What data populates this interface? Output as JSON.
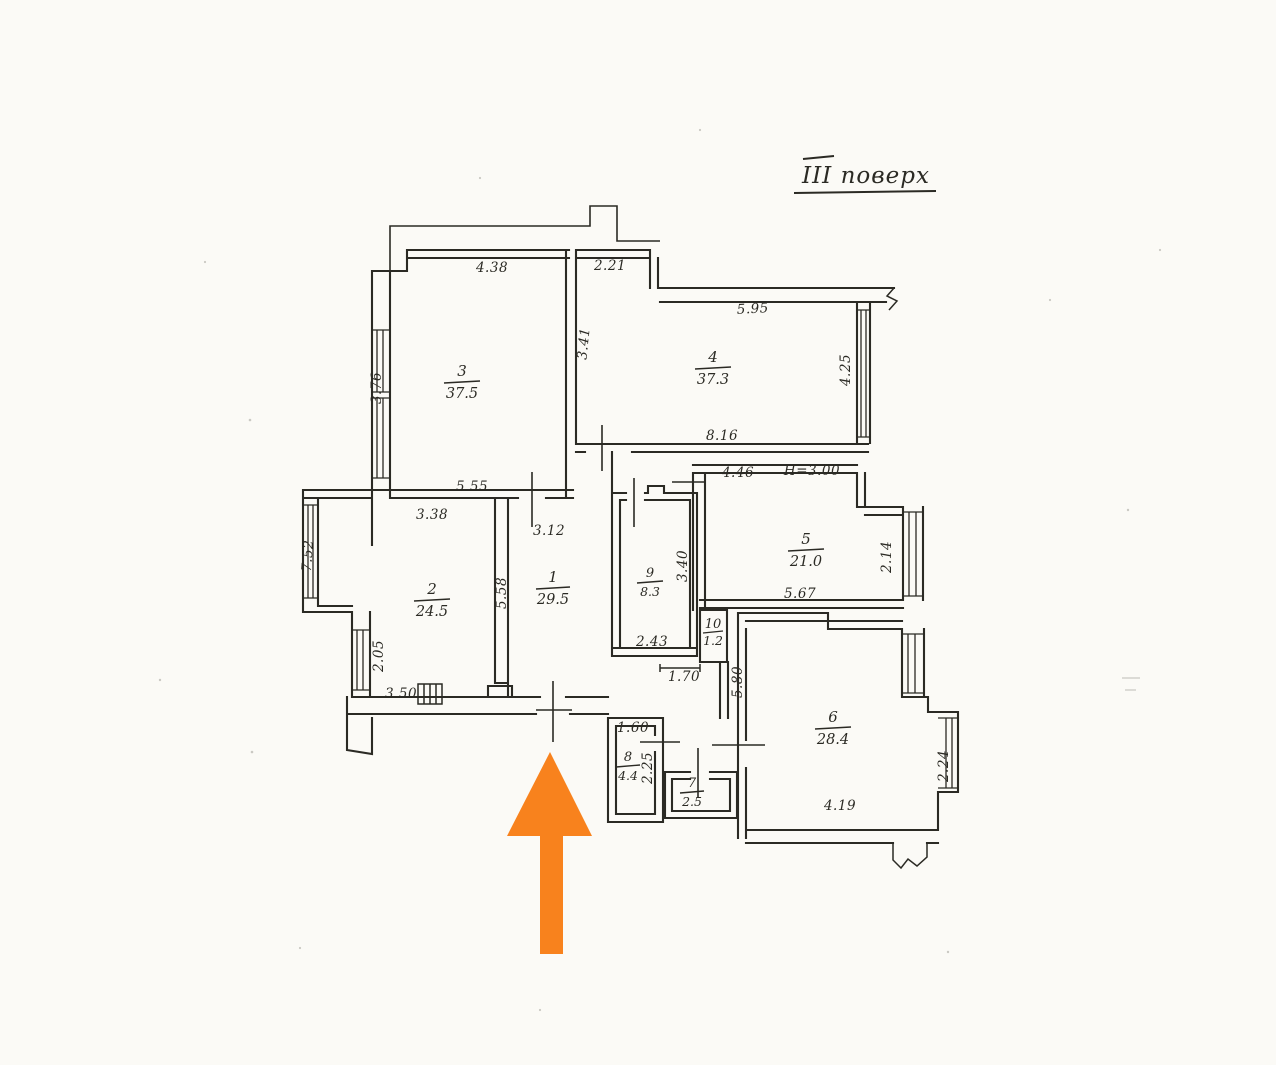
{
  "page": {
    "paper_color": "#fbfaf6",
    "ink_color": "#2b2a24"
  },
  "title": {
    "text": "III поверх"
  },
  "arrow": {
    "color": "#F8821D"
  },
  "rooms": {
    "r1": {
      "number": "1",
      "area": "29.5"
    },
    "r2": {
      "number": "2",
      "area": "24.5"
    },
    "r3": {
      "number": "3",
      "area": "37.5"
    },
    "r4": {
      "number": "4",
      "area": "37.3"
    },
    "r5": {
      "number": "5",
      "area": "21.0"
    },
    "r6": {
      "number": "6",
      "area": "28.4"
    },
    "r7": {
      "number": "7",
      "area": "2.5"
    },
    "r8": {
      "number": "8",
      "area": "4.4"
    },
    "r9": {
      "number": "9",
      "area": "8.3"
    },
    "r10": {
      "number": "10",
      "area": "1.2"
    }
  },
  "dimensions": {
    "room3_top": "4.38",
    "room3_left": "3.76",
    "room3_right": "3.41",
    "room3_bottom": "5.55",
    "room3_below": "3.38",
    "room4_topleft": "2.21",
    "room4_top": "5.95",
    "room4_right": "4.25",
    "room4_bottom": "8.16",
    "room5_topleft": "4.46",
    "height_note": "Н=3.00",
    "room5_bottom": "5.67",
    "room5_right": "2.14",
    "room2_left": "7.52",
    "room2_left_lower": "2.05",
    "room2_bottom": "3.50",
    "room1_top": "3.12",
    "room1_left": "5.58",
    "room9_right": "3.40",
    "room9_bottom": "2.43",
    "room9_below": "1.70",
    "room6_left": "5.80",
    "room6_bottom": "4.19",
    "room6_right": "2.24",
    "room8_top": "1.60",
    "room8_right": "2.25"
  }
}
